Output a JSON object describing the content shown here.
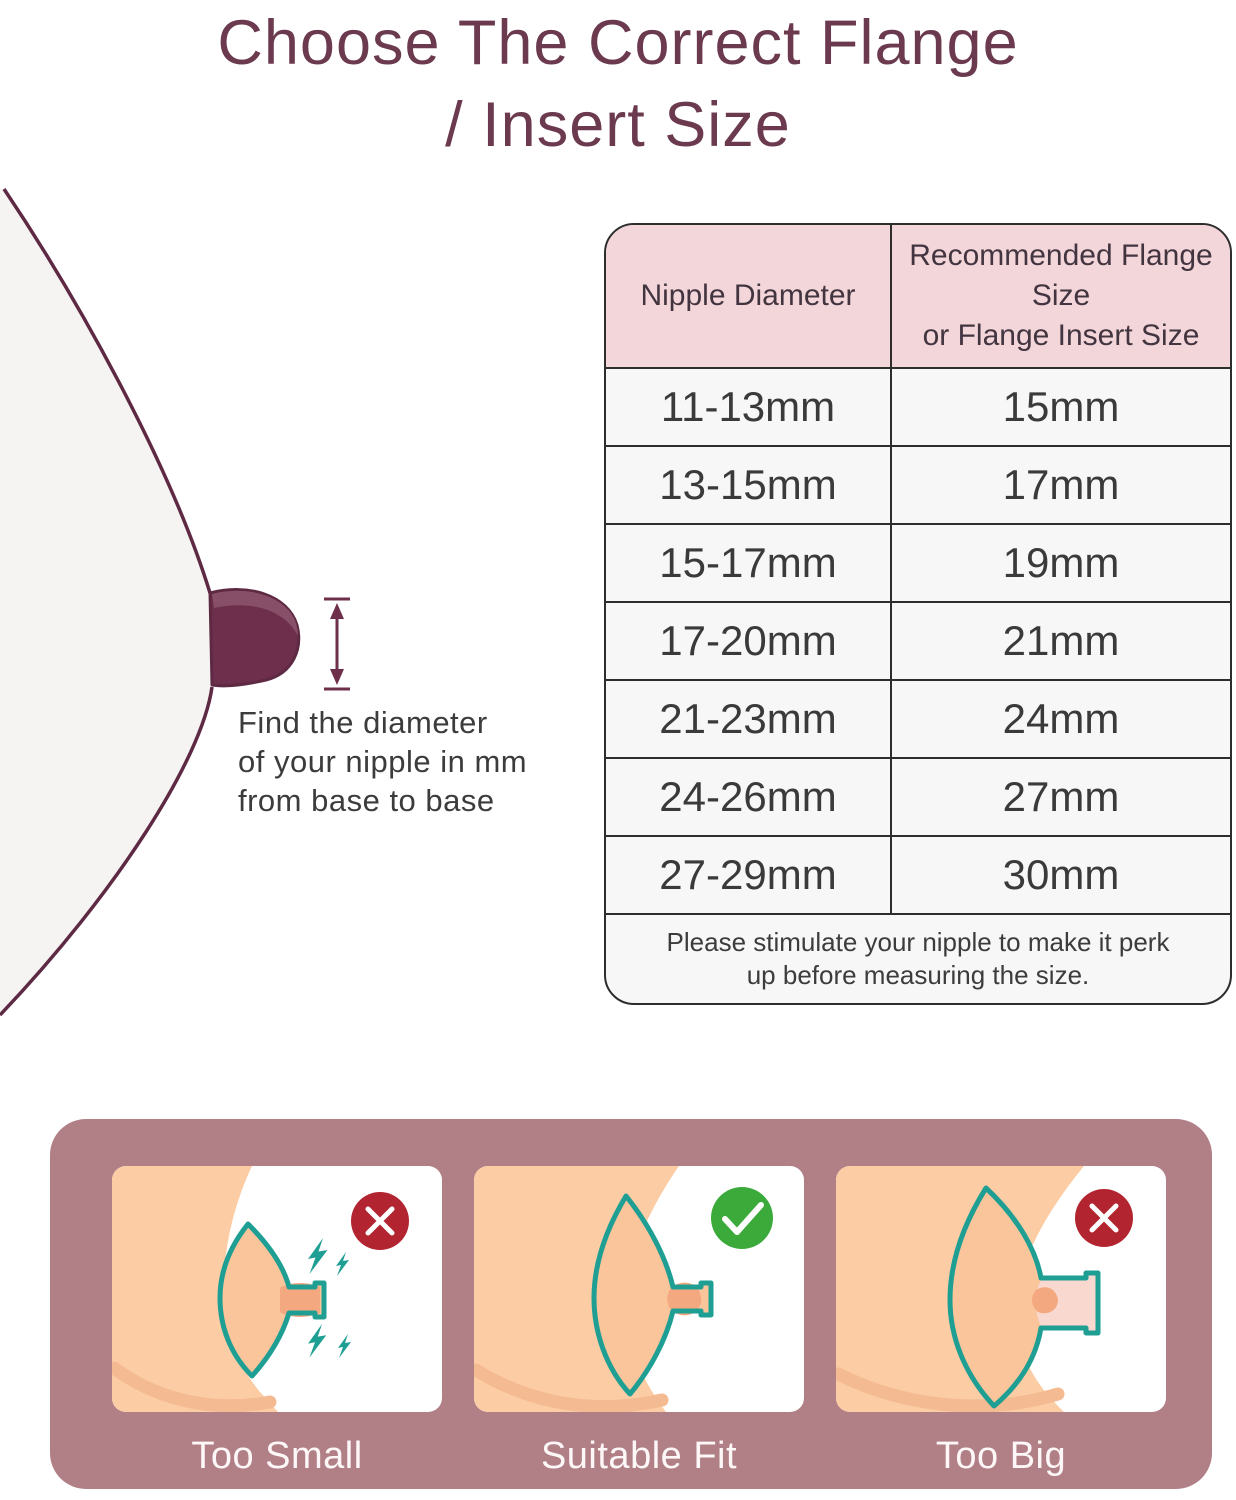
{
  "title": {
    "line1": "Choose The Correct Flange",
    "line2": "/ Insert Size"
  },
  "measurement": {
    "line1": "Find the diameter",
    "line2": "of your nipple in mm",
    "line3": "from base to base"
  },
  "table": {
    "header": {
      "col1": "Nipple Diameter",
      "col2_line1": "Recommended Flange Size",
      "col2_line2": "or Flange Insert Size"
    },
    "rows": [
      {
        "diameter": "11-13mm",
        "flange": "15mm"
      },
      {
        "diameter": "13-15mm",
        "flange": "17mm"
      },
      {
        "diameter": "15-17mm",
        "flange": "19mm"
      },
      {
        "diameter": "17-20mm",
        "flange": "21mm"
      },
      {
        "diameter": "21-23mm",
        "flange": "24mm"
      },
      {
        "diameter": "24-26mm",
        "flange": "27mm"
      },
      {
        "diameter": "27-29mm",
        "flange": "30mm"
      }
    ],
    "note_line1": "Please stimulate your nipple to make it perk",
    "note_line2": "up before measuring the size."
  },
  "fit_guide": {
    "cards": [
      {
        "label": "Too Small",
        "status": "bad",
        "badge_icon": "x-mark"
      },
      {
        "label": "Suitable Fit",
        "status": "good",
        "badge_icon": "check-mark"
      },
      {
        "label": "Too Big",
        "status": "bad",
        "badge_icon": "x-mark"
      }
    ]
  },
  "colors": {
    "title_maroon": "#6b3a4f",
    "outline_maroon": "#5e2943",
    "nipple_maroon": "#6d2f4b",
    "nipple_highlight": "#885068",
    "table_header_bg": "#f3d6da",
    "table_body_bg": "#f8f7f7",
    "table_border": "#2d2d2d",
    "text_gray": "#3c3c3c",
    "panel_mauve": "#b18087",
    "skin": "#fccda4",
    "skin_shade": "#f4ba92",
    "cone_skin": "#fac59b",
    "nipple_skin": "#f3a87f",
    "tunnel_pink": "#f8d8cf",
    "teal": "#1f9f93",
    "badge_red": "#b2242f",
    "badge_green": "#3caa3a"
  }
}
